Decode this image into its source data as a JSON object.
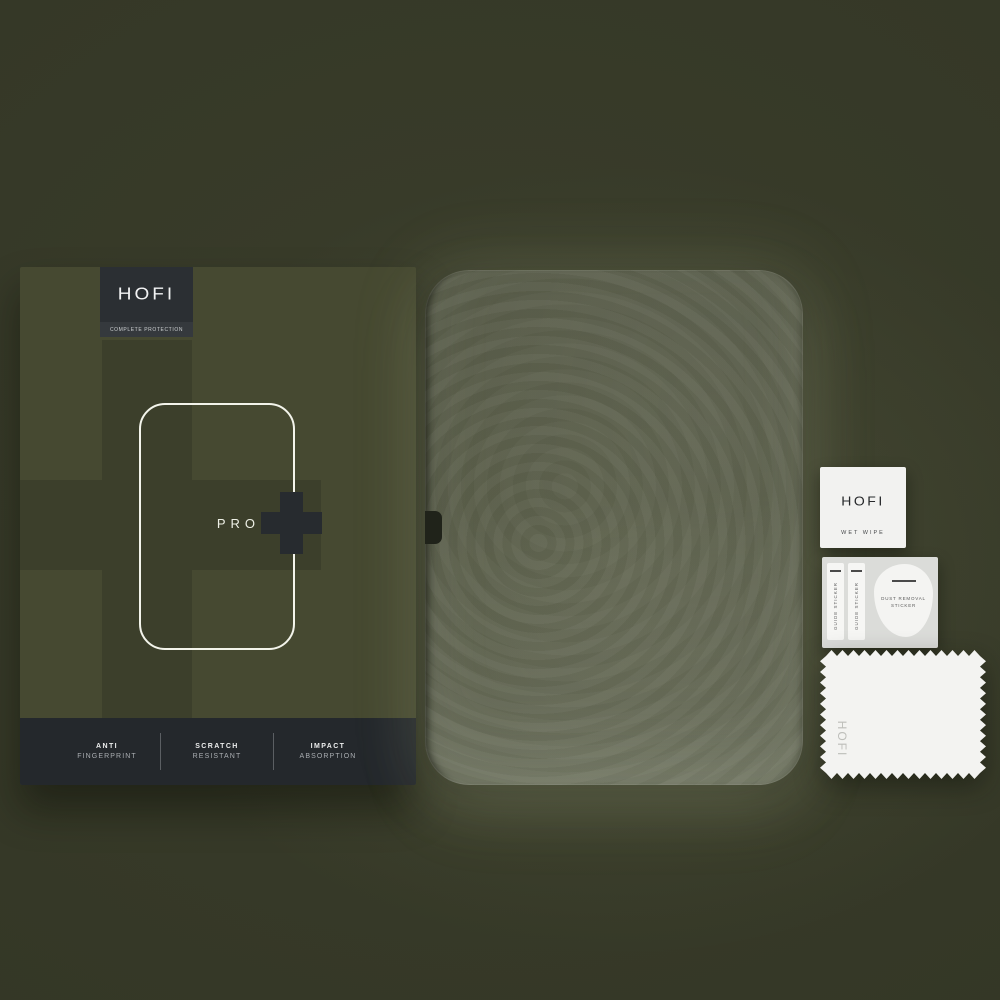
{
  "box": {
    "brand": "HOFI",
    "tagline": "COMPLETE PROTECTION",
    "line_label": "PRO",
    "features": [
      {
        "line1": "ANTI",
        "line2": "FINGERPRINT"
      },
      {
        "line1": "SCRATCH",
        "line2": "RESISTANT"
      },
      {
        "line1": "IMPACT",
        "line2": "ABSORPTION"
      }
    ]
  },
  "accessories": {
    "wet_wipe": {
      "brand": "HOFI",
      "label": "WET WIPE"
    },
    "stickers": {
      "guide_label": "GUIDE STICKER",
      "dust_line1": "DUST REMOVAL",
      "dust_line2": "STICKER"
    },
    "cloth": {
      "brand": "HOFI"
    }
  },
  "colors": {
    "background_olive": "#343726",
    "box_olive": "#464931",
    "box_cross_olive": "#3c3f2b",
    "charcoal_dark": "#24282c",
    "badge_charcoal": "#2b2f33",
    "outline_white": "#f3f4eb",
    "glass_tint": "#5a5e4f",
    "paper_white": "#f3f3f1"
  }
}
